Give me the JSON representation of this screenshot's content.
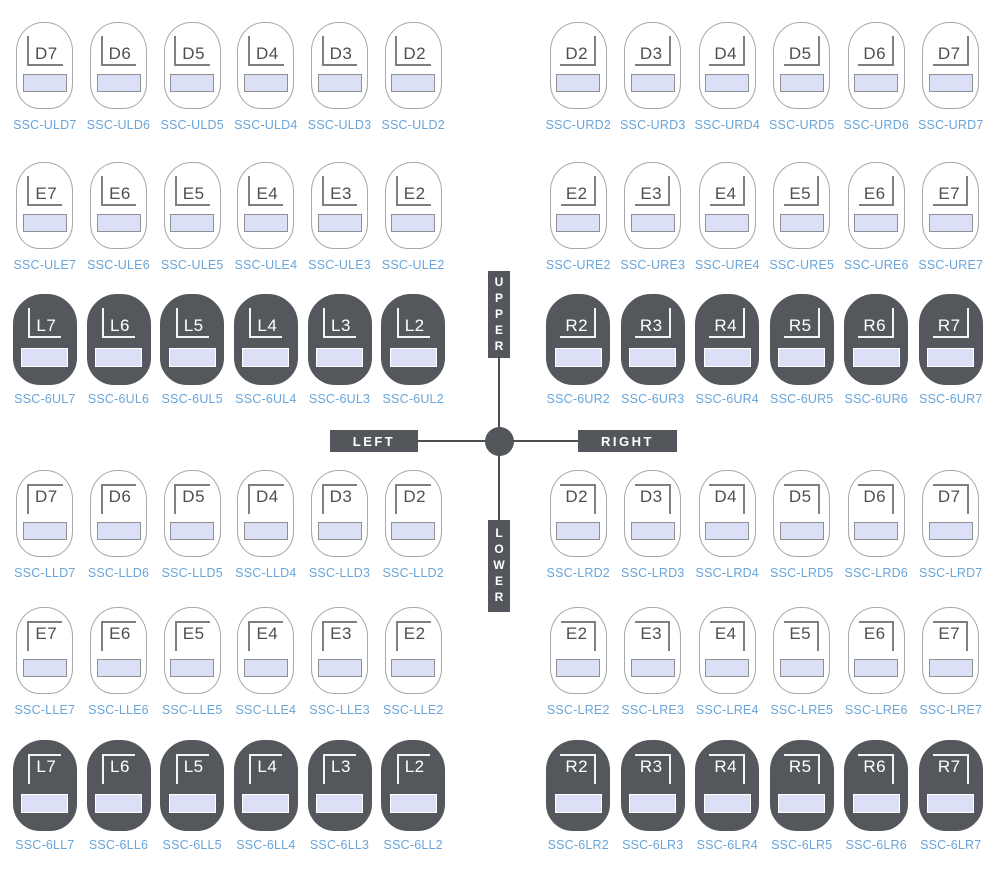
{
  "legend": {
    "upper": "UPPER",
    "lower": "LOWER",
    "left": "LEFT",
    "right": "RIGHT"
  },
  "colors": {
    "dark_tooth_fill": "#54585d",
    "light_tooth_outline": "#a6a8ab",
    "band_fill": "#dbe0f6",
    "band_border_light": "#8f9094",
    "band_border_dark": "#ffffff",
    "code_text": "#69a5d9",
    "axis_box": "#53575c",
    "axis_text": "#ffffff"
  },
  "groups": [
    {
      "id": "uld",
      "quadrant": "upper-left",
      "dark": false,
      "items": [
        {
          "label": "D7",
          "code": "SSC-ULD7"
        },
        {
          "label": "D6",
          "code": "SSC-ULD6"
        },
        {
          "label": "D5",
          "code": "SSC-ULD5"
        },
        {
          "label": "D4",
          "code": "SSC-ULD4"
        },
        {
          "label": "D3",
          "code": "SSC-ULD3"
        },
        {
          "label": "D2",
          "code": "SSC-ULD2"
        }
      ]
    },
    {
      "id": "urd",
      "quadrant": "upper-right",
      "dark": false,
      "items": [
        {
          "label": "D2",
          "code": "SSC-URD2"
        },
        {
          "label": "D3",
          "code": "SSC-URD3"
        },
        {
          "label": "D4",
          "code": "SSC-URD4"
        },
        {
          "label": "D5",
          "code": "SSC-URD5"
        },
        {
          "label": "D6",
          "code": "SSC-URD6"
        },
        {
          "label": "D7",
          "code": "SSC-URD7"
        }
      ]
    },
    {
      "id": "ule",
      "quadrant": "upper-left",
      "dark": false,
      "items": [
        {
          "label": "E7",
          "code": "SSC-ULE7"
        },
        {
          "label": "E6",
          "code": "SSC-ULE6"
        },
        {
          "label": "E5",
          "code": "SSC-ULE5"
        },
        {
          "label": "E4",
          "code": "SSC-ULE4"
        },
        {
          "label": "E3",
          "code": "SSC-ULE3"
        },
        {
          "label": "E2",
          "code": "SSC-ULE2"
        }
      ]
    },
    {
      "id": "ure",
      "quadrant": "upper-right",
      "dark": false,
      "items": [
        {
          "label": "E2",
          "code": "SSC-URE2"
        },
        {
          "label": "E3",
          "code": "SSC-URE3"
        },
        {
          "label": "E4",
          "code": "SSC-URE4"
        },
        {
          "label": "E5",
          "code": "SSC-URE5"
        },
        {
          "label": "E6",
          "code": "SSC-URE6"
        },
        {
          "label": "E7",
          "code": "SSC-URE7"
        }
      ]
    },
    {
      "id": "6ul",
      "quadrant": "upper-left",
      "dark": true,
      "items": [
        {
          "label": "L7",
          "code": "SSC-6UL7"
        },
        {
          "label": "L6",
          "code": "SSC-6UL6"
        },
        {
          "label": "L5",
          "code": "SSC-6UL5"
        },
        {
          "label": "L4",
          "code": "SSC-6UL4"
        },
        {
          "label": "L3",
          "code": "SSC-6UL3"
        },
        {
          "label": "L2",
          "code": "SSC-6UL2"
        }
      ]
    },
    {
      "id": "6ur",
      "quadrant": "upper-right",
      "dark": true,
      "items": [
        {
          "label": "R2",
          "code": "SSC-6UR2"
        },
        {
          "label": "R3",
          "code": "SSC-6UR3"
        },
        {
          "label": "R4",
          "code": "SSC-6UR4"
        },
        {
          "label": "R5",
          "code": "SSC-6UR5"
        },
        {
          "label": "R6",
          "code": "SSC-6UR6"
        },
        {
          "label": "R7",
          "code": "SSC-6UR7"
        }
      ]
    },
    {
      "id": "lld",
      "quadrant": "lower-left",
      "dark": false,
      "items": [
        {
          "label": "D7",
          "code": "SSC-LLD7"
        },
        {
          "label": "D6",
          "code": "SSC-LLD6"
        },
        {
          "label": "D5",
          "code": "SSC-LLD5"
        },
        {
          "label": "D4",
          "code": "SSC-LLD4"
        },
        {
          "label": "D3",
          "code": "SSC-LLD3"
        },
        {
          "label": "D2",
          "code": "SSC-LLD2"
        }
      ]
    },
    {
      "id": "lrd",
      "quadrant": "lower-right",
      "dark": false,
      "items": [
        {
          "label": "D2",
          "code": "SSC-LRD2"
        },
        {
          "label": "D3",
          "code": "SSC-LRD3"
        },
        {
          "label": "D4",
          "code": "SSC-LRD4"
        },
        {
          "label": "D5",
          "code": "SSC-LRD5"
        },
        {
          "label": "D6",
          "code": "SSC-LRD6"
        },
        {
          "label": "D7",
          "code": "SSC-LRD7"
        }
      ]
    },
    {
      "id": "lle",
      "quadrant": "lower-left",
      "dark": false,
      "items": [
        {
          "label": "E7",
          "code": "SSC-LLE7"
        },
        {
          "label": "E6",
          "code": "SSC-LLE6"
        },
        {
          "label": "E5",
          "code": "SSC-LLE5"
        },
        {
          "label": "E4",
          "code": "SSC-LLE4"
        },
        {
          "label": "E3",
          "code": "SSC-LLE3"
        },
        {
          "label": "E2",
          "code": "SSC-LLE2"
        }
      ]
    },
    {
      "id": "lre",
      "quadrant": "lower-right",
      "dark": false,
      "items": [
        {
          "label": "E2",
          "code": "SSC-LRE2"
        },
        {
          "label": "E3",
          "code": "SSC-LRE3"
        },
        {
          "label": "E4",
          "code": "SSC-LRE4"
        },
        {
          "label": "E5",
          "code": "SSC-LRE5"
        },
        {
          "label": "E6",
          "code": "SSC-LRE6"
        },
        {
          "label": "E7",
          "code": "SSC-LRE7"
        }
      ]
    },
    {
      "id": "6ll",
      "quadrant": "lower-left",
      "dark": true,
      "items": [
        {
          "label": "L7",
          "code": "SSC-6LL7"
        },
        {
          "label": "L6",
          "code": "SSC-6LL6"
        },
        {
          "label": "L5",
          "code": "SSC-6LL5"
        },
        {
          "label": "L4",
          "code": "SSC-6LL4"
        },
        {
          "label": "L3",
          "code": "SSC-6LL3"
        },
        {
          "label": "L2",
          "code": "SSC-6LL2"
        }
      ]
    },
    {
      "id": "6lr",
      "quadrant": "lower-right",
      "dark": true,
      "items": [
        {
          "label": "R2",
          "code": "SSC-6LR2"
        },
        {
          "label": "R3",
          "code": "SSC-6LR3"
        },
        {
          "label": "R4",
          "code": "SSC-6LR4"
        },
        {
          "label": "R5",
          "code": "SSC-6LR5"
        },
        {
          "label": "R6",
          "code": "SSC-6LR6"
        },
        {
          "label": "R7",
          "code": "SSC-6LR7"
        }
      ]
    }
  ]
}
